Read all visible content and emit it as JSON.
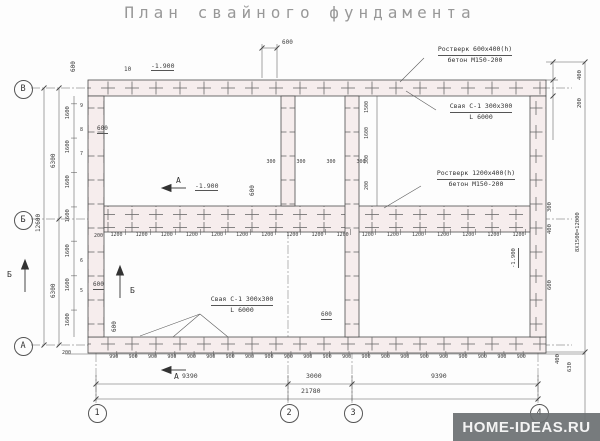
{
  "title": "План свайного фундамента",
  "watermark": "HOME-IDEAS.RU",
  "axes": {
    "left": [
      "В",
      "Б",
      "А"
    ],
    "bottom": [
      "1",
      "2",
      "3",
      "4"
    ]
  },
  "sections": {
    "a1": "А",
    "a2": "А",
    "b1": "Б",
    "b2": "Б"
  },
  "annotations": {
    "rostverk_top": {
      "l1": "Ростверк 600х400(h)",
      "l2": "бетон М150-200"
    },
    "pile_right": {
      "l1": "Свая С-1 300х300",
      "l2": "L 6000"
    },
    "rostverk_mid": {
      "l1": "Ростверк 1200х400(h)",
      "l2": "бетон М150-200"
    },
    "pile_bottom": {
      "l1": "Свая С-1 300х300",
      "l2": "L 6000"
    },
    "elev_top": "-1.900",
    "elev_mid": "-1.900",
    "elev_right": "-1.900",
    "count_top": "10"
  },
  "dims": {
    "total_w": "21780",
    "spans": [
      "9390",
      "3000",
      "9390"
    ],
    "total_h": "12600",
    "halves": [
      "6300",
      "6300"
    ],
    "col1600": [
      "1600",
      "1600",
      "1600",
      "1600",
      "1600",
      "1600",
      "1600"
    ],
    "row900": [
      "990",
      "900",
      "900",
      "900",
      "900",
      "900",
      "900",
      "900",
      "900",
      "900",
      "900",
      "900",
      "900",
      "900",
      "900",
      "900",
      "900",
      "900",
      "900",
      "900",
      "900",
      "900"
    ],
    "row1200": [
      "1200",
      "1200",
      "1200",
      "1200",
      "1200",
      "1200",
      "1200",
      "1200",
      "1200",
      "1200",
      "1200",
      "1200",
      "1200",
      "1200",
      "1200",
      "1200",
      "1200"
    ],
    "row300": [
      "300",
      "300",
      "300",
      "300"
    ],
    "v2col": [
      "1500",
      "1600",
      "300",
      "200"
    ],
    "pilenums_top": [
      "9",
      "8",
      "7"
    ],
    "pilenums_bottom": [
      "6",
      "5"
    ],
    "lead200": "200",
    "corner200": "200",
    "top600": "600",
    "corner600": "600",
    "left600a": "600",
    "left600b": "600",
    "mid600": "600",
    "bl600": "600",
    "bc600": "600",
    "right": {
      "r400a": "400",
      "r200": "200",
      "r300": "300",
      "r400b": "400",
      "r600": "600",
      "rtotal": "8Х1500=12000",
      "r400c": "400",
      "r630": "630"
    }
  }
}
